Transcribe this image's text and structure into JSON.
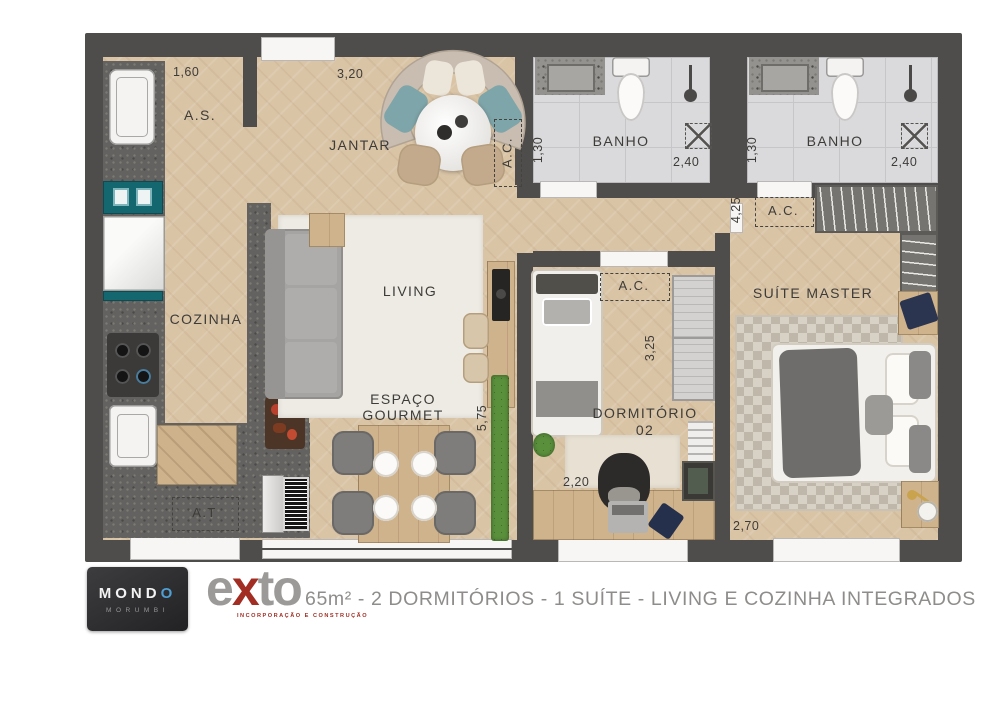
{
  "plan": {
    "labels": {
      "as": "A.S.",
      "jantar": "JANTAR",
      "cozinha": "COZINHA",
      "living": "LIVING",
      "gourmet_line1": "ESPAÇO",
      "gourmet_line2": "GOURMET",
      "banho": "BANHO",
      "at": "A.T",
      "ac": "A.C.",
      "dorm_line1": "DORMITÓRIO",
      "dorm_line2": "02",
      "suite": "SUÍTE MASTER"
    },
    "dimensions": {
      "as_width": "1,60",
      "jantar_width": "3,20",
      "banho_depth": "1,30",
      "banho_width": "2,40",
      "living_height": "5,75",
      "suite_hall_height": "4,25",
      "dorm_height": "3,25",
      "dorm_width": "2,20",
      "suite_width": "2,70"
    },
    "colors": {
      "wall": "#4e4d4b",
      "wood_floor": "#d9c4a6",
      "bath_tile": "#dadadc",
      "accent_teal": "#14666f",
      "granite": "#636260"
    }
  },
  "footer": {
    "mondo_name_part1": "MOND",
    "mondo_name_part2": "O",
    "mondo_sub": "MORUMBI",
    "exto_part1": "e",
    "exto_part2": "x",
    "exto_part3": "to",
    "exto_sub": "INCORPORAÇÃO E CONSTRUÇÃO",
    "caption": "65m² - 2 DORMITÓRIOS - 1 SUÍTE - LIVING E COZINHA INTEGRADOS"
  }
}
